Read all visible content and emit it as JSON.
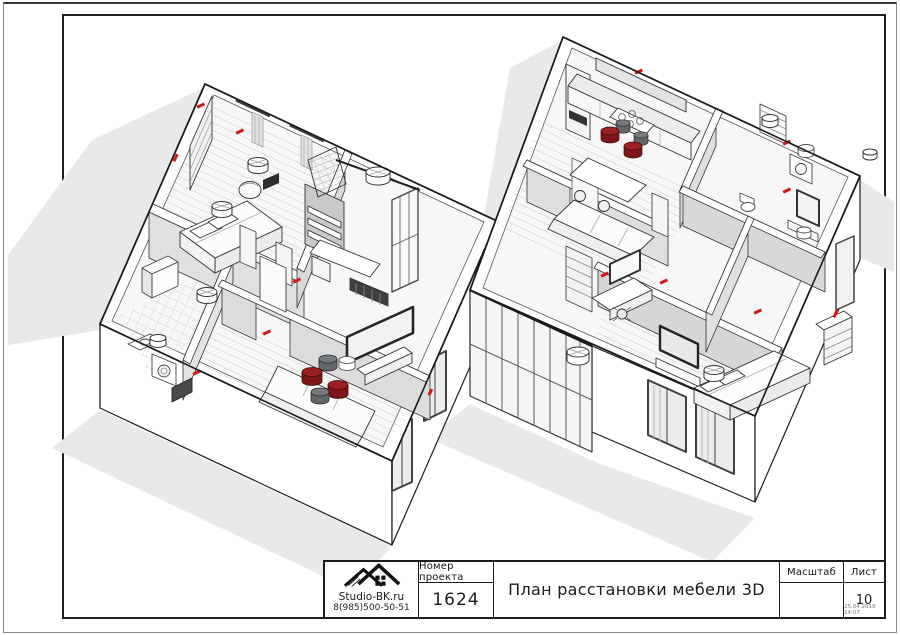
{
  "title_block": {
    "brand": "Studio-BK.ru",
    "phone": "8(985)500-50-51",
    "project_number_label": "Номер проекта",
    "project_number": "1624",
    "drawing_title": "План расстановки мебели 3D",
    "scale_label": "Масштаб",
    "scale_value": "",
    "sheet_label": "Лист",
    "sheet_number": "10",
    "print_stamp": "25.04.2019 14:07"
  },
  "drawing": {
    "subject": "3D furniture arrangement plan of two apartment units",
    "palette": {
      "line_black": "#1c1c1c",
      "wall_gray": "#d8d8d8",
      "shadow_gray": "#e9e9e9",
      "accent_red": "#d01616",
      "pouf_dark_red": "#8d1b1e",
      "pouf_gray": "#63676a"
    }
  }
}
